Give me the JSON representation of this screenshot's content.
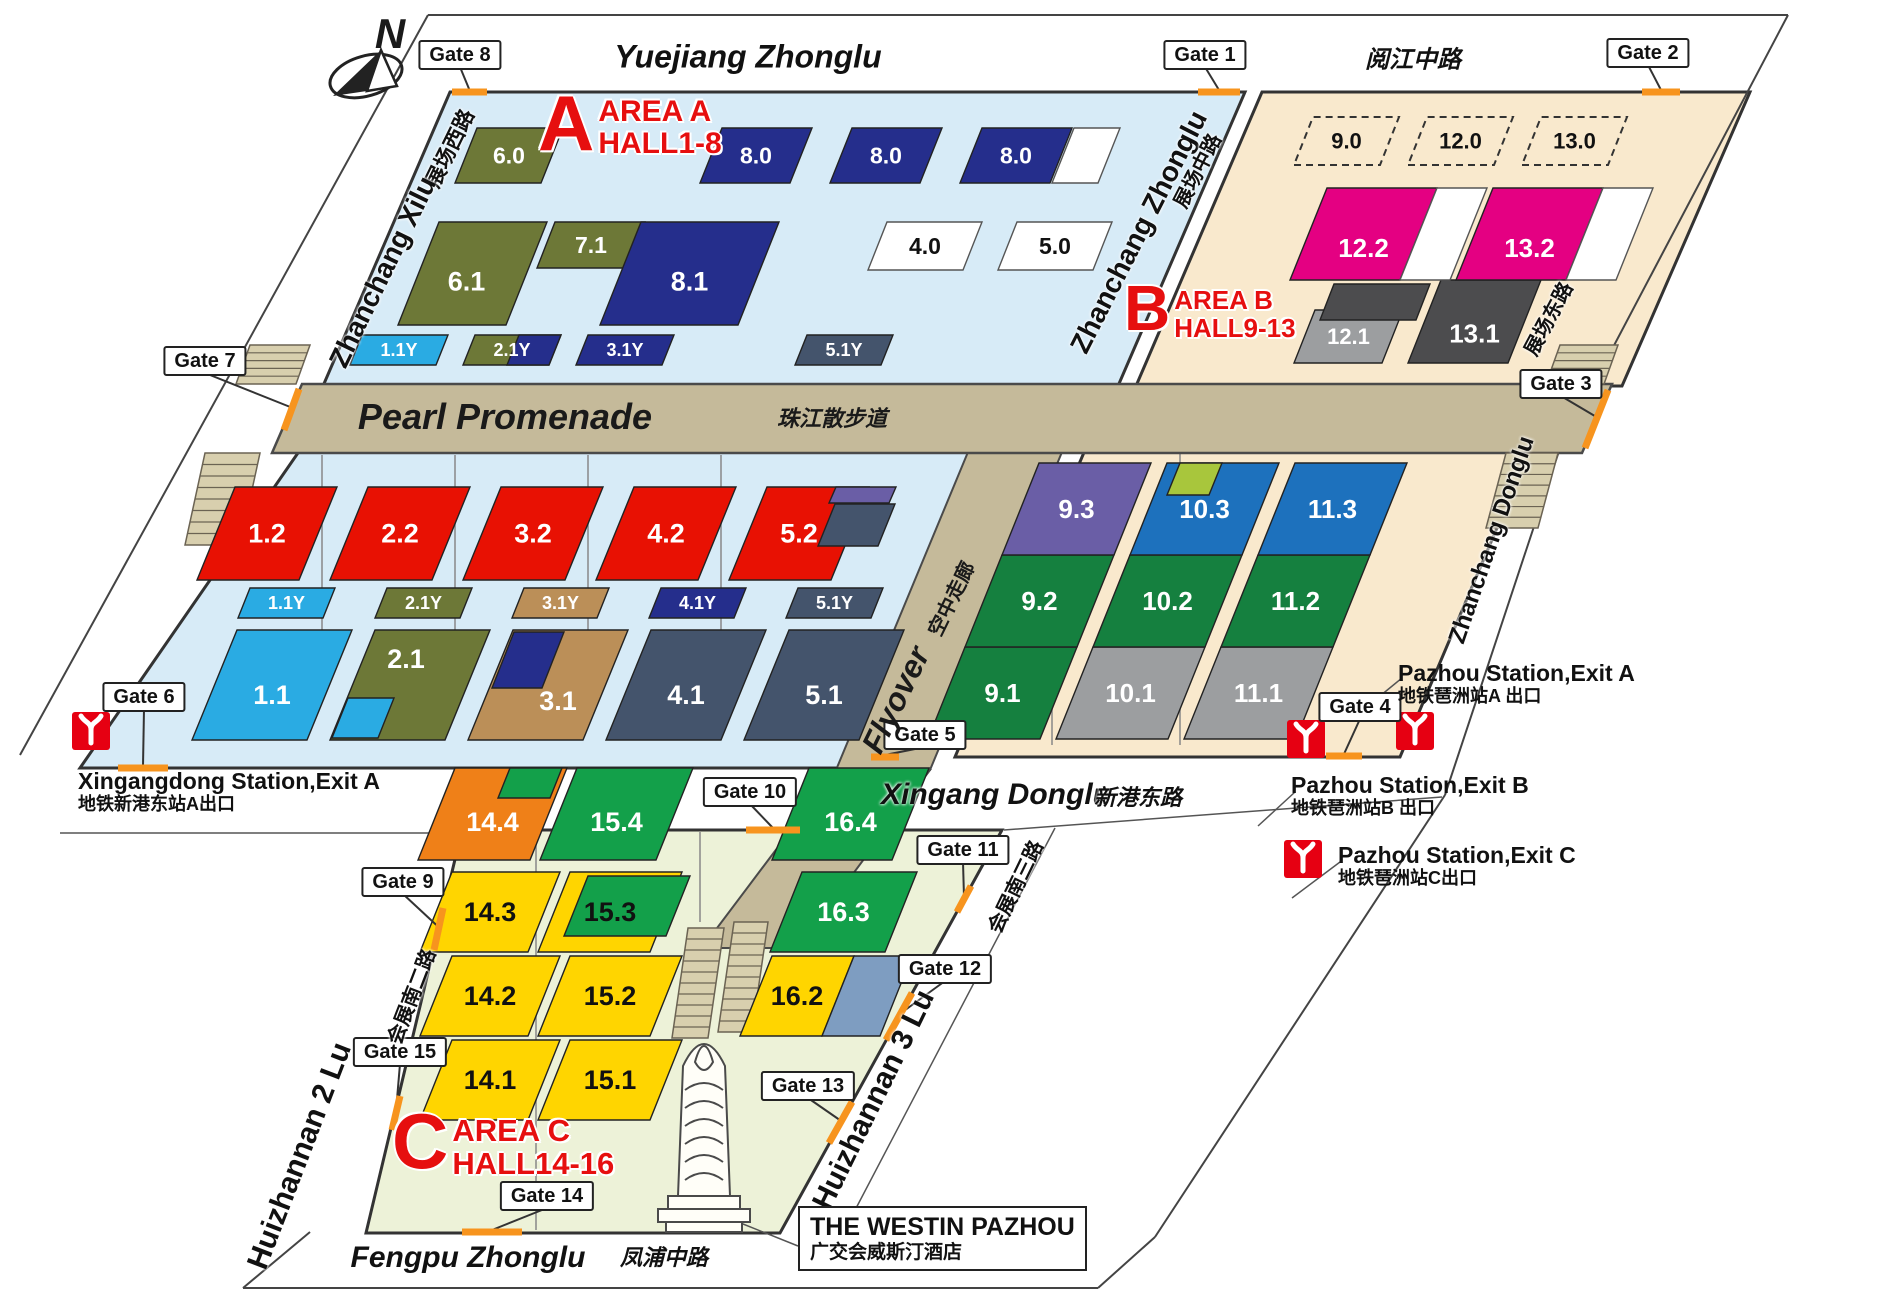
{
  "canvas": {
    "w": 1900,
    "h": 1316
  },
  "compass": {
    "label": "N"
  },
  "colors": {
    "navy": "#252e8c",
    "olive": "#6d7837",
    "lblue": "#2aabe3",
    "red": "#e81103",
    "tan": "#bb8f58",
    "dslate": "#44546c",
    "purple": "#6a5ea6",
    "pink": "#e40082",
    "blue": "#1d71bd",
    "ygreen": "#a8c63c",
    "bgreen": "#15803f",
    "cgreen": "#13a04a",
    "gray": "#9c9ea0",
    "dgray": "#4c4c4e",
    "yellow": "#ffd500",
    "corange": "#ef8018",
    "bgray": "#7e9dc1",
    "white": "#ffffff",
    "platformBlue": "#d7ebf7",
    "platformBeige": "#f9e9cd",
    "platformGreen": "#edf2d8",
    "walkway": "#c5ba9a",
    "gateOrange": "#f7941e",
    "metroRed": "#e60012",
    "titleRed": "#e60f0f"
  },
  "areas": [
    {
      "letter": "A",
      "title": "AREA A",
      "subtitle": "HALL1-8",
      "x": 538,
      "y": 92,
      "ls": 78,
      "ts": 30
    },
    {
      "letter": "B",
      "title": "AREA B",
      "subtitle": "HALL9-13",
      "x": 1124,
      "y": 282,
      "ls": 64,
      "ts": 26
    },
    {
      "letter": "C",
      "title": "AREA C",
      "subtitle": "HALL14-16",
      "x": 392,
      "y": 1110,
      "ls": 78,
      "ts": 31
    }
  ],
  "streets": [
    {
      "name": "Yuejiang Zhonglu",
      "x": 748,
      "y": 57,
      "rot": 0,
      "size": 32,
      "it": true
    },
    {
      "name": "阅江中路",
      "x": 1413,
      "y": 57,
      "rot": 0,
      "size": 24,
      "it": true
    },
    {
      "name": "展场西路",
      "x": 449,
      "y": 148,
      "rot": -64,
      "size": 21,
      "it": false
    },
    {
      "name": "Zhanchang Xilu",
      "x": 383,
      "y": 272,
      "rot": -64,
      "size": 28,
      "it": false
    },
    {
      "name": "Zhanchang Zhonglu",
      "x": 1139,
      "y": 232,
      "rot": -63,
      "size": 28,
      "it": false
    },
    {
      "name": "展场中路",
      "x": 1196,
      "y": 170,
      "rot": -63,
      "size": 20,
      "it": false
    },
    {
      "name": "展场东路",
      "x": 1547,
      "y": 318,
      "rot": -62,
      "size": 20,
      "it": false
    },
    {
      "name": "Zhanchang Donglu",
      "x": 1492,
      "y": 540,
      "rot": -71,
      "size": 24,
      "it": false
    },
    {
      "name": "Xingang Donglu",
      "x": 996,
      "y": 795,
      "rot": 0,
      "size": 30,
      "it": true
    },
    {
      "name": "新港东路",
      "x": 1138,
      "y": 796,
      "rot": 0,
      "size": 22,
      "it": true
    },
    {
      "name": "会展南三路",
      "x": 1014,
      "y": 886,
      "rot": -64,
      "size": 20,
      "it": false
    },
    {
      "name": "Huizhannan 3 Lu",
      "x": 874,
      "y": 1100,
      "rot": -64,
      "size": 30,
      "it": false
    },
    {
      "name": "会展南二路",
      "x": 410,
      "y": 996,
      "rot": -69,
      "size": 20,
      "it": false
    },
    {
      "name": "Huizhannan 2 Lu",
      "x": 300,
      "y": 1156,
      "rot": -69,
      "size": 30,
      "it": false
    },
    {
      "name": "Fengpu Zhonglu",
      "x": 468,
      "y": 1258,
      "rot": 0,
      "size": 30,
      "it": true
    },
    {
      "name": "凤浦中路",
      "x": 664,
      "y": 1256,
      "rot": 0,
      "size": 22,
      "it": true
    }
  ],
  "landmarks": {
    "promenade": {
      "en": "Pearl Promenade",
      "cn": "珠江散步道"
    },
    "flyover": {
      "en": "Flyover",
      "cn": "空中走廊"
    },
    "westin": {
      "en": "THE WESTIN PAZHOU",
      "cn": "广交会威斯汀酒店"
    }
  },
  "stations": [
    {
      "en": "Xingangdong Station,Exit A",
      "cn": "地铁新港东站A出口",
      "tx": 78,
      "ty": 768,
      "ix": 72,
      "iy": 712
    },
    {
      "en": "Pazhou Station,Exit A",
      "cn": "地铁琶洲站A 出口",
      "tx": 1398,
      "ty": 660,
      "ix": 1396,
      "iy": 712
    },
    {
      "en": "Pazhou Station,Exit B",
      "cn": "地铁琶洲站B 出口",
      "tx": 1291,
      "ty": 772,
      "ix": 1287,
      "iy": 720
    },
    {
      "en": "Pazhou Station,Exit C",
      "cn": "地铁琶洲站C出口",
      "tx": 1338,
      "ty": 842,
      "ix": 1284,
      "iy": 840
    }
  ],
  "gates": [
    {
      "label": "Gate 1",
      "bx": 1205,
      "by": 55,
      "seg": [
        1198,
        92,
        1240,
        92
      ]
    },
    {
      "label": "Gate 2",
      "bx": 1648,
      "by": 53,
      "seg": [
        1642,
        92,
        1680,
        92
      ]
    },
    {
      "label": "Gate 3",
      "bx": 1561,
      "by": 384,
      "seg": [
        1608,
        390,
        1585,
        448
      ]
    },
    {
      "label": "Gate 4",
      "bx": 1360,
      "by": 707,
      "seg": [
        1326,
        756,
        1362,
        756
      ]
    },
    {
      "label": "Gate 5",
      "bx": 925,
      "by": 735,
      "seg": [
        871,
        757,
        899,
        757
      ]
    },
    {
      "label": "Gate 6",
      "bx": 144,
      "by": 697,
      "seg": [
        118,
        768,
        168,
        768
      ]
    },
    {
      "label": "Gate 7",
      "bx": 205,
      "by": 361,
      "seg": [
        299,
        389,
        284,
        430
      ]
    },
    {
      "label": "Gate 8",
      "bx": 460,
      "by": 55,
      "seg": [
        452,
        92,
        487,
        92
      ]
    },
    {
      "label": "Gate 9",
      "bx": 403,
      "by": 882,
      "seg": [
        443,
        908,
        434,
        950
      ]
    },
    {
      "label": "Gate 10",
      "bx": 750,
      "by": 792,
      "seg": [
        746,
        830,
        800,
        830
      ]
    },
    {
      "label": "Gate 11",
      "bx": 963,
      "by": 850,
      "seg": [
        971,
        886,
        957,
        912
      ]
    },
    {
      "label": "Gate 12",
      "bx": 945,
      "by": 969,
      "seg": [
        912,
        993,
        886,
        1040
      ]
    },
    {
      "label": "Gate 13",
      "bx": 808,
      "by": 1086,
      "seg": [
        852,
        1102,
        829,
        1143
      ]
    },
    {
      "label": "Gate 14",
      "bx": 547,
      "by": 1196,
      "seg": [
        462,
        1232,
        522,
        1232
      ]
    },
    {
      "label": "Gate 15",
      "bx": 400,
      "by": 1052,
      "seg": [
        400,
        1096,
        392,
        1130
      ]
    }
  ],
  "halls": [
    {
      "label": "6.0",
      "x": 455,
      "y": 183,
      "w": 86,
      "h": 55,
      "s": 22,
      "f": "olive",
      "fs": 23
    },
    {
      "label": "8.0",
      "x": 700,
      "y": 183,
      "w": 90,
      "h": 55,
      "s": 22,
      "f": "navy",
      "fs": 23
    },
    {
      "label": "8.0",
      "x": 830,
      "y": 183,
      "w": 90,
      "h": 55,
      "s": 22,
      "f": "navy",
      "fs": 23
    },
    {
      "label": "8.0",
      "x": 960,
      "y": 183,
      "w": 90,
      "h": 55,
      "s": 22,
      "f": "navy",
      "fs": 23,
      "extras": [
        {
          "x": 1052,
          "y": 183,
          "w": 46,
          "h": 55,
          "s": 22,
          "f": "white"
        }
      ]
    },
    {
      "label": "6.1",
      "x": 398,
      "y": 325,
      "w": 108,
      "h": 103,
      "s": 41,
      "f": "olive",
      "fs": 27,
      "dx": -6,
      "dy": 8
    },
    {
      "label": "7.1",
      "x": 537,
      "y": 268,
      "w": 90,
      "h": 46,
      "s": 18,
      "f": "olive",
      "fs": 23
    },
    {
      "label": "8.1",
      "x": 600,
      "y": 325,
      "w": 138,
      "h": 103,
      "s": 41,
      "f": "navy",
      "fs": 27,
      "dy": 8
    },
    {
      "label": "4.0",
      "x": 868,
      "y": 270,
      "w": 95,
      "h": 48,
      "s": 19,
      "f": "white",
      "tc": "#111",
      "fs": 23
    },
    {
      "label": "5.0",
      "x": 998,
      "y": 270,
      "w": 95,
      "h": 48,
      "s": 19,
      "f": "white",
      "tc": "#111",
      "fs": 23
    },
    {
      "label": "1.1Y",
      "x": 350,
      "y": 365,
      "w": 86,
      "h": 30,
      "s": 12,
      "f": "lblue",
      "fs": 18
    },
    {
      "label": "2.1Y",
      "x": 463,
      "y": 365,
      "w": 86,
      "h": 30,
      "s": 12,
      "f": "olive",
      "fs": 18,
      "extras": [
        {
          "x": 507,
          "y": 365,
          "w": 42,
          "h": 30,
          "s": 12,
          "f": "navy"
        }
      ]
    },
    {
      "label": "3.1Y",
      "x": 576,
      "y": 365,
      "w": 86,
      "h": 30,
      "s": 12,
      "f": "navy",
      "fs": 18
    },
    {
      "label": "5.1Y",
      "x": 795,
      "y": 365,
      "w": 86,
      "h": 30,
      "s": 12,
      "f": "dslate",
      "fs": 18
    },
    {
      "label": "1.2",
      "x": 197,
      "y": 580,
      "w": 102,
      "h": 93,
      "s": 38,
      "f": "red",
      "fs": 27
    },
    {
      "label": "2.2",
      "x": 330,
      "y": 580,
      "w": 102,
      "h": 93,
      "s": 38,
      "f": "red",
      "fs": 27
    },
    {
      "label": "3.2",
      "x": 463,
      "y": 580,
      "w": 102,
      "h": 93,
      "s": 38,
      "f": "red",
      "fs": 27
    },
    {
      "label": "4.2",
      "x": 596,
      "y": 580,
      "w": 102,
      "h": 93,
      "s": 38,
      "f": "red",
      "fs": 27
    },
    {
      "label": "5.2",
      "x": 729,
      "y": 580,
      "w": 102,
      "h": 93,
      "s": 38,
      "f": "red",
      "fs": 27,
      "extras": [
        {
          "x": 829,
          "y": 503,
          "w": 60,
          "h": 16,
          "s": 7,
          "f": "purple"
        },
        {
          "x": 818,
          "y": 546,
          "w": 60,
          "h": 42,
          "s": 17,
          "f": "dslate"
        }
      ]
    },
    {
      "label": "1.1Y",
      "x": 238,
      "y": 618,
      "w": 85,
      "h": 30,
      "s": 12,
      "f": "lblue",
      "fs": 18
    },
    {
      "label": "2.1Y",
      "x": 375,
      "y": 618,
      "w": 85,
      "h": 30,
      "s": 12,
      "f": "olive",
      "fs": 18
    },
    {
      "label": "3.1Y",
      "x": 512,
      "y": 618,
      "w": 85,
      "h": 30,
      "s": 12,
      "f": "tan",
      "fs": 18
    },
    {
      "label": "4.1Y",
      "x": 649,
      "y": 618,
      "w": 85,
      "h": 30,
      "s": 12,
      "f": "navy",
      "fs": 18
    },
    {
      "label": "5.1Y",
      "x": 786,
      "y": 618,
      "w": 85,
      "h": 30,
      "s": 12,
      "f": "dslate",
      "fs": 18
    },
    {
      "label": "1.1",
      "x": 192,
      "y": 740,
      "w": 115,
      "h": 110,
      "s": 45,
      "f": "lblue",
      "fs": 27,
      "dy": 10
    },
    {
      "label": "2.1",
      "x": 330,
      "y": 740,
      "w": 115,
      "h": 110,
      "s": 45,
      "f": "olive",
      "fs": 27,
      "dy": -26,
      "dx": -4,
      "extras": [
        {
          "x": 332,
          "y": 738,
          "w": 46,
          "h": 40,
          "s": 16,
          "f": "lblue"
        }
      ]
    },
    {
      "label": "3.1",
      "x": 468,
      "y": 740,
      "w": 115,
      "h": 110,
      "s": 45,
      "f": "tan",
      "fs": 27,
      "dy": 16,
      "dx": 10,
      "extras": [
        {
          "x": 492,
          "y": 688,
          "w": 50,
          "h": 56,
          "s": 22,
          "f": "navy"
        }
      ]
    },
    {
      "label": "4.1",
      "x": 606,
      "y": 740,
      "w": 115,
      "h": 110,
      "s": 45,
      "f": "dslate",
      "fs": 27,
      "dy": 10
    },
    {
      "label": "5.1",
      "x": 744,
      "y": 740,
      "w": 115,
      "h": 110,
      "s": 45,
      "f": "dslate",
      "fs": 27,
      "dy": 10
    },
    {
      "label": "9.0",
      "x": 1294,
      "y": 165,
      "w": 86,
      "h": 48,
      "s": 19,
      "f": "none",
      "tc": "#111",
      "fs": 22,
      "dash": true
    },
    {
      "label": "12.0",
      "x": 1408,
      "y": 165,
      "w": 86,
      "h": 48,
      "s": 19,
      "f": "none",
      "tc": "#111",
      "fs": 22,
      "dash": true
    },
    {
      "label": "13.0",
      "x": 1522,
      "y": 165,
      "w": 86,
      "h": 48,
      "s": 19,
      "f": "none",
      "tc": "#111",
      "fs": 22,
      "dash": true
    },
    {
      "label": "12.1",
      "x": 1294,
      "y": 363,
      "w": 88,
      "h": 53,
      "s": 21,
      "f": "gray",
      "fs": 22
    },
    {
      "label": "",
      "x": 1320,
      "y": 320,
      "w": 96,
      "h": 36,
      "s": 14,
      "f": "dgray"
    },
    {
      "label": "13.1",
      "x": 1408,
      "y": 363,
      "w": 100,
      "h": 83,
      "s": 33,
      "f": "dgray",
      "fs": 26,
      "dy": 12
    },
    {
      "label": "12.2",
      "x": 1290,
      "y": 280,
      "w": 110,
      "h": 92,
      "s": 37,
      "f": "pink",
      "fs": 26,
      "dy": 14,
      "extras": [
        {
          "x": 1400,
          "y": 280,
          "w": 50,
          "h": 92,
          "s": 37,
          "f": "white"
        }
      ]
    },
    {
      "label": "13.2",
      "x": 1456,
      "y": 280,
      "w": 110,
      "h": 92,
      "s": 37,
      "f": "pink",
      "fs": 26,
      "dy": 14,
      "extras": [
        {
          "x": 1566,
          "y": 280,
          "w": 50,
          "h": 92,
          "s": 37,
          "f": "white"
        }
      ]
    },
    {
      "label": "9.1",
      "x": 928,
      "y": 739,
      "w": 112,
      "h": 92,
      "s": 37,
      "f": "bgreen",
      "fs": 26
    },
    {
      "label": "10.1",
      "x": 1056,
      "y": 739,
      "w": 112,
      "h": 92,
      "s": 37,
      "f": "gray",
      "fs": 26
    },
    {
      "label": "11.1",
      "x": 1184,
      "y": 739,
      "w": 112,
      "h": 92,
      "s": 37,
      "f": "gray",
      "fs": 26
    },
    {
      "label": "9.2",
      "x": 965,
      "y": 647,
      "w": 112,
      "h": 92,
      "s": 37,
      "f": "bgreen",
      "fs": 26
    },
    {
      "label": "10.2",
      "x": 1093,
      "y": 647,
      "w": 112,
      "h": 92,
      "s": 37,
      "f": "bgreen",
      "fs": 26
    },
    {
      "label": "11.2",
      "x": 1221,
      "y": 647,
      "w": 112,
      "h": 92,
      "s": 37,
      "f": "bgreen",
      "fs": 26
    },
    {
      "label": "9.3",
      "x": 1002,
      "y": 555,
      "w": 112,
      "h": 92,
      "s": 37,
      "f": "purple",
      "fs": 26
    },
    {
      "label": "10.3",
      "x": 1130,
      "y": 555,
      "w": 112,
      "h": 92,
      "s": 37,
      "f": "blue",
      "fs": 26,
      "extras": [
        {
          "x": 1167,
          "y": 495,
          "w": 42,
          "h": 32,
          "s": 13,
          "f": "ygreen"
        }
      ]
    },
    {
      "label": "11.3",
      "x": 1258,
      "y": 555,
      "w": 112,
      "h": 92,
      "s": 37,
      "f": "blue",
      "fs": 26
    },
    {
      "label": "14.4",
      "x": 418,
      "y": 860,
      "w": 112,
      "h": 92,
      "s": 37,
      "f": "corange",
      "fs": 27,
      "dy": 8,
      "extras": [
        {
          "x": 498,
          "y": 798,
          "w": 52,
          "h": 30,
          "s": 12,
          "f": "cgreen"
        }
      ]
    },
    {
      "label": "15.4",
      "x": 540,
      "y": 860,
      "w": 116,
      "h": 92,
      "s": 37,
      "f": "cgreen",
      "fs": 27,
      "dy": 8
    },
    {
      "label": "16.4",
      "x": 772,
      "y": 860,
      "w": 120,
      "h": 92,
      "s": 37,
      "f": "cgreen",
      "fs": 27,
      "dy": 8
    },
    {
      "label": "14.3",
      "x": 420,
      "y": 952,
      "w": 108,
      "h": 80,
      "s": 32,
      "f": "yellow",
      "tc": "#111",
      "fs": 27
    },
    {
      "label": "15.3",
      "x": 538,
      "y": 952,
      "w": 112,
      "h": 80,
      "s": 32,
      "f": "yellow",
      "tc": "#111",
      "fs": 27,
      "extras": [
        {
          "x": 564,
          "y": 936,
          "w": 102,
          "h": 60,
          "s": 24,
          "f": "cgreen"
        }
      ]
    },
    {
      "label": "16.3",
      "x": 770,
      "y": 952,
      "w": 115,
      "h": 80,
      "s": 32,
      "f": "cgreen",
      "fs": 27
    },
    {
      "label": "14.2",
      "x": 420,
      "y": 1036,
      "w": 108,
      "h": 80,
      "s": 32,
      "f": "yellow",
      "tc": "#111",
      "fs": 27
    },
    {
      "label": "15.2",
      "x": 538,
      "y": 1036,
      "w": 112,
      "h": 80,
      "s": 32,
      "f": "yellow",
      "tc": "#111",
      "fs": 27
    },
    {
      "label": "16.2",
      "x": 740,
      "y": 1036,
      "w": 82,
      "h": 80,
      "s": 32,
      "f": "yellow",
      "tc": "#111",
      "fs": 27,
      "extras": [
        {
          "x": 822,
          "y": 1036,
          "w": 58,
          "h": 80,
          "s": 32,
          "f": "bgray"
        }
      ]
    },
    {
      "label": "14.1",
      "x": 420,
      "y": 1120,
      "w": 108,
      "h": 80,
      "s": 32,
      "f": "yellow",
      "tc": "#111",
      "fs": 27
    },
    {
      "label": "15.1",
      "x": 538,
      "y": 1120,
      "w": 112,
      "h": 80,
      "s": 32,
      "f": "yellow",
      "tc": "#111",
      "fs": 27
    }
  ]
}
